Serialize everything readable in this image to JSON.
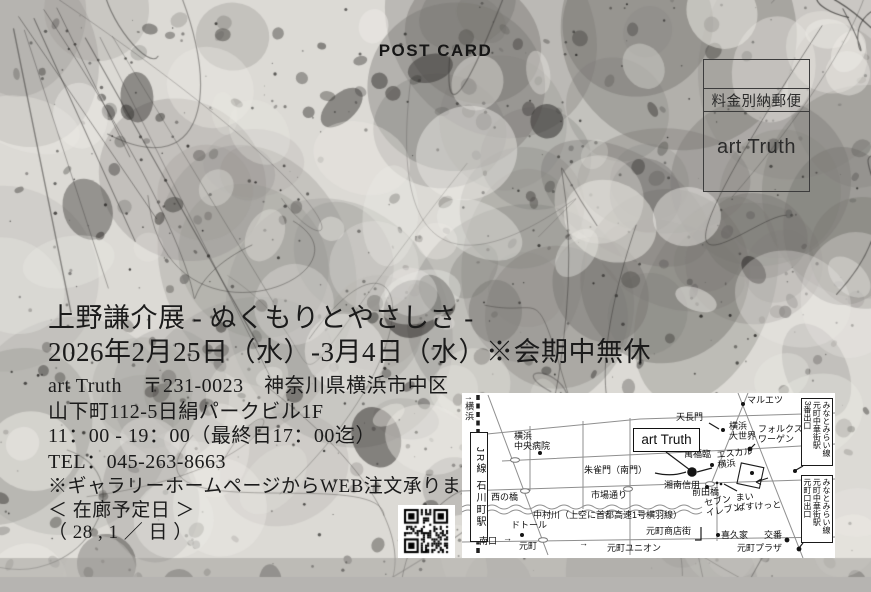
{
  "postcard": {
    "label": "POST CARD",
    "stamp_box": {
      "line1": "料金別納郵便",
      "line2": "art Truth"
    },
    "title": "上野謙介展 - ぬくもりとやさしさ -",
    "dates": "2026年2月25日（水）-3月4日（水）※会期中無休",
    "address_line1": "art Truth　〒231-0023　神奈川県横浜市中区",
    "address_line2": "山下町112-5日絹パークビル1F",
    "hours": "11：00 - 19：00（最終日17：00迄）",
    "tel": "TEL：045-263-8663",
    "web_note": "※ギャラリーホームページからWEB注文承ります",
    "visit_label": "＜ 在廊予定日 ＞",
    "visit_days": "（ 28 , 1 ／ 日 ）"
  },
  "icons": {
    "qr": "qr-code-icon"
  },
  "map": {
    "labels": [
      {
        "id": "yokohama-direction",
        "text": "↑横浜",
        "x": 2,
        "y": 3,
        "cls": "m-vert dir"
      },
      {
        "id": "station-jr-ishikawacho",
        "text": "JR線 石川町駅",
        "x": 8,
        "y": 39,
        "w": 18,
        "h": 110,
        "cls": "m-vert station"
      },
      {
        "id": "yokohama-chuo-hospital",
        "text": "横浜\n中央病院",
        "x": 52,
        "y": 38,
        "cls": ""
      },
      {
        "id": "nishinohashi-bridge",
        "text": "西の橋",
        "x": 29,
        "y": 99,
        "cls": ""
      },
      {
        "id": "ichiba-dori",
        "text": "市場通り",
        "x": 129,
        "y": 97,
        "cls": ""
      },
      {
        "id": "nakamura-river",
        "text": "中村川（上空に首都高速1号横羽線）",
        "x": 71,
        "y": 117,
        "cls": ""
      },
      {
        "id": "doutor",
        "text": "ドトール",
        "x": 49,
        "y": 127,
        "cls": ""
      },
      {
        "id": "minamiguchi-exit",
        "text": "南口",
        "x": 17,
        "y": 143,
        "cls": ""
      },
      {
        "id": "motomachi",
        "text": "元町",
        "x": 57,
        "y": 148,
        "cls": ""
      },
      {
        "id": "arrow-left-street",
        "text": "→",
        "x": 41,
        "y": 140,
        "cls": ""
      },
      {
        "id": "arrow-mid-street",
        "text": "→",
        "x": 117,
        "y": 145,
        "cls": ""
      },
      {
        "id": "tenchomon-gate",
        "text": "天長門",
        "x": 214,
        "y": 19,
        "cls": ""
      },
      {
        "id": "maruetsu",
        "text": "マルエツ",
        "x": 285,
        "y": 2,
        "cls": ""
      },
      {
        "id": "yokohama-daisekai",
        "text": "横浜\n大世界",
        "x": 267,
        "y": 28,
        "cls": ""
      },
      {
        "id": "volkswagen",
        "text": "フォルクス\nワーゲン",
        "x": 296,
        "y": 31,
        "cls": ""
      },
      {
        "id": "manpukurin",
        "text": "萬福臨",
        "x": 222,
        "y": 56,
        "cls": ""
      },
      {
        "id": "escal-yokohama",
        "text": "エスカル\n横浜",
        "x": 255,
        "y": 55,
        "cls": "skew"
      },
      {
        "id": "suzakumon-gate",
        "text": "朱雀門（南門）",
        "x": 122,
        "y": 72,
        "cls": ""
      },
      {
        "id": "shonan-shinyo-bank",
        "text": "湘南信用",
        "x": 202,
        "y": 87,
        "cls": ""
      },
      {
        "id": "maedabashi-bridge",
        "text": "前田橋",
        "x": 230,
        "y": 94,
        "cls": ""
      },
      {
        "id": "seven-eleven",
        "text": "セブン\nイレブン",
        "x": 243,
        "y": 102,
        "cls": "rot"
      },
      {
        "id": "my-basket",
        "text": "まい\nばすけっと",
        "x": 274,
        "y": 98,
        "cls": "rot2"
      },
      {
        "id": "motomachi-shotengai",
        "text": "元町商店街",
        "x": 184,
        "y": 133,
        "cls": ""
      },
      {
        "id": "kikuya",
        "text": "喜久家",
        "x": 259,
        "y": 137,
        "cls": ""
      },
      {
        "id": "koban-police-box",
        "text": "交番",
        "x": 302,
        "y": 137,
        "cls": ""
      },
      {
        "id": "motomachi-union",
        "text": "元町ユニオン",
        "x": 145,
        "y": 150,
        "cls": ""
      },
      {
        "id": "motomachi-plaza",
        "text": "元町プラザ",
        "x": 275,
        "y": 150,
        "cls": ""
      },
      {
        "id": "exit-box-no3",
        "text": "みなとみらい線\n元町中華街駅\n3番出口",
        "x": 339,
        "y": 5,
        "w": 32,
        "h": 68,
        "cls": "m-vert exitbox"
      },
      {
        "id": "exit-box-motomachiguchi",
        "text": "みなとみらい線\n元町中華街駅\n元町口出口",
        "x": 339,
        "y": 82,
        "w": 32,
        "h": 68,
        "cls": "m-vert exitbox"
      },
      {
        "id": "art-truth-gallery-box",
        "text": "art Truth",
        "x": 171,
        "y": 35,
        "w": 67,
        "h": 24,
        "cls": "atbox"
      }
    ]
  },
  "colors": {
    "card_bg": "#dcdad5",
    "bottom_band": "#b6b4b1",
    "ink": "#1b1b1b",
    "map_bg": "#ffffff",
    "road": "#8f8f8f"
  }
}
